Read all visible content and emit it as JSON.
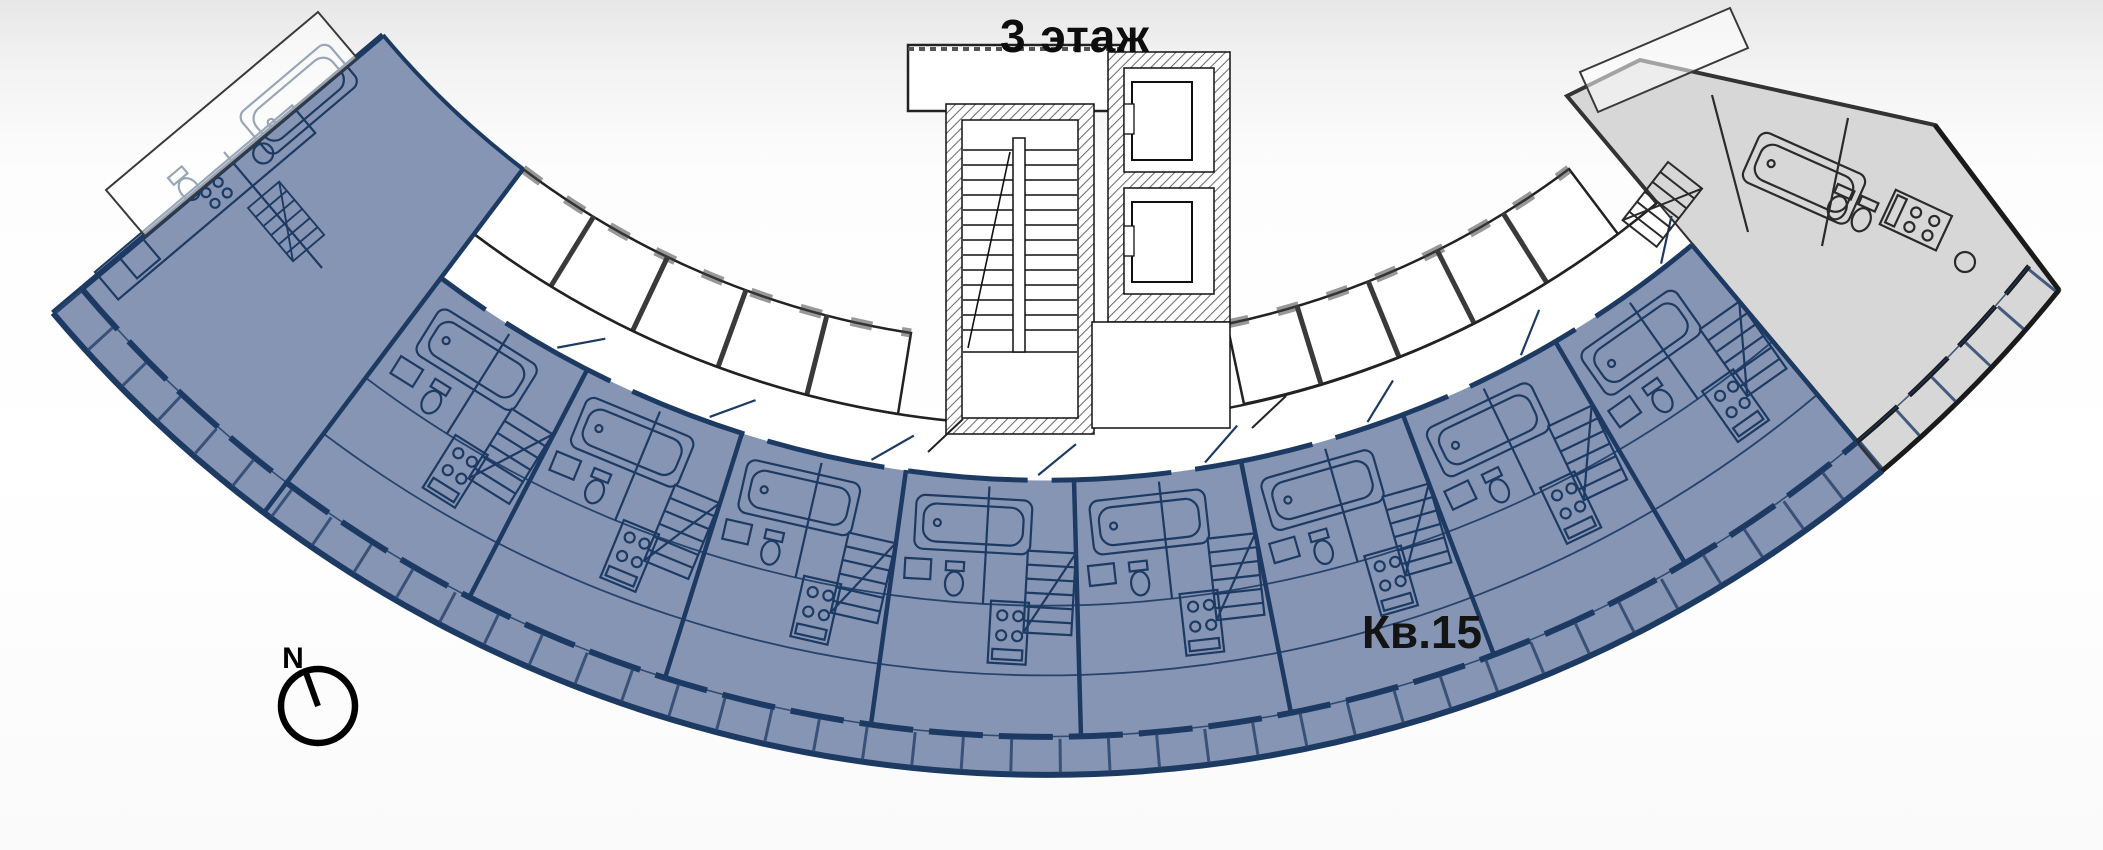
{
  "title": "3 этаж",
  "apartment_label": "Кв.15",
  "compass": {
    "label": "N"
  },
  "floor": {
    "number": "3"
  },
  "highlighted_apartment": {
    "number": "15",
    "label": "Кв.15"
  },
  "colors": {
    "highlight_fill": "#8695B4",
    "highlight_line": "#1D3A63",
    "neighbor_unit_fill": "#D7D7D7",
    "plan_line": "#1A1A1A",
    "background_top": "#E8E8E8",
    "background_bottom": "#FFFFFF"
  }
}
